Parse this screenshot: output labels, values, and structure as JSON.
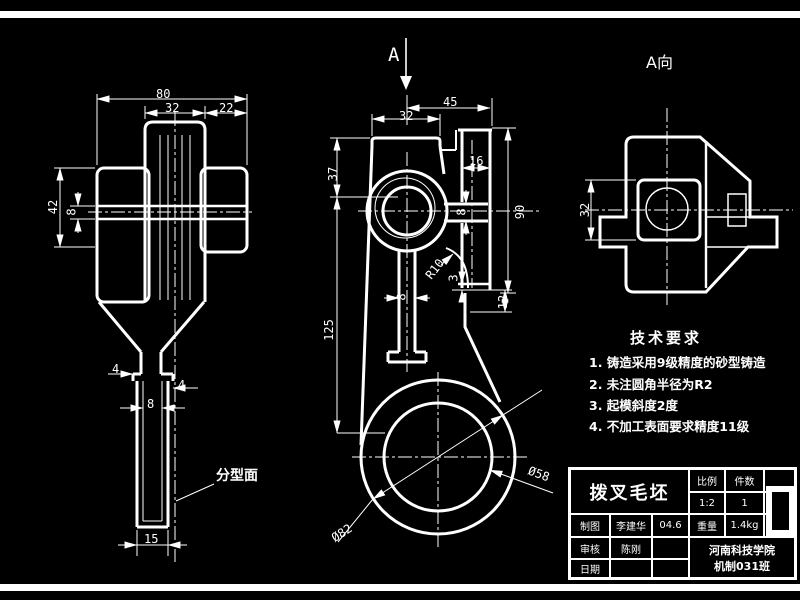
{
  "lv": {
    "d80": "80",
    "d32": "32",
    "d22": "22",
    "d42": "42",
    "d8a": "8",
    "d4a": "4",
    "d4b": "4",
    "d8b": "8",
    "d15": "15",
    "parting": "分型面"
  },
  "fv": {
    "a": "A",
    "d45": "45",
    "d32": "32",
    "d16": "16",
    "d37": "37",
    "d125": "125",
    "d90": "90",
    "d8a": "8",
    "d8b": "8",
    "r10": "R10",
    "d3": "3",
    "d12": "12",
    "dia82": "Ø82",
    "dia58": "Ø58"
  },
  "av": {
    "label": "A向",
    "d32": "32"
  },
  "notes": {
    "title": "技术要求",
    "items": [
      "1. 铸造采用9级精度的砂型铸造",
      "2. 未注圆角半径为R2",
      "3. 起模斜度2度",
      "4. 不加工表面要求精度11级"
    ]
  },
  "tb": {
    "part_name": "拨叉毛坯",
    "scale_label": "比例",
    "scale_value": "1:2",
    "qty_label": "件数",
    "qty_value": "1",
    "drawn_label": "制图",
    "drawn_name": "李建华",
    "drawn_date": "04.6",
    "weight_label": "重量",
    "weight_value": "1.4kg",
    "check_label": "审核",
    "check_name": "陈刚",
    "date_label": "日期",
    "school": "河南科技学院",
    "class": "机制031班"
  }
}
